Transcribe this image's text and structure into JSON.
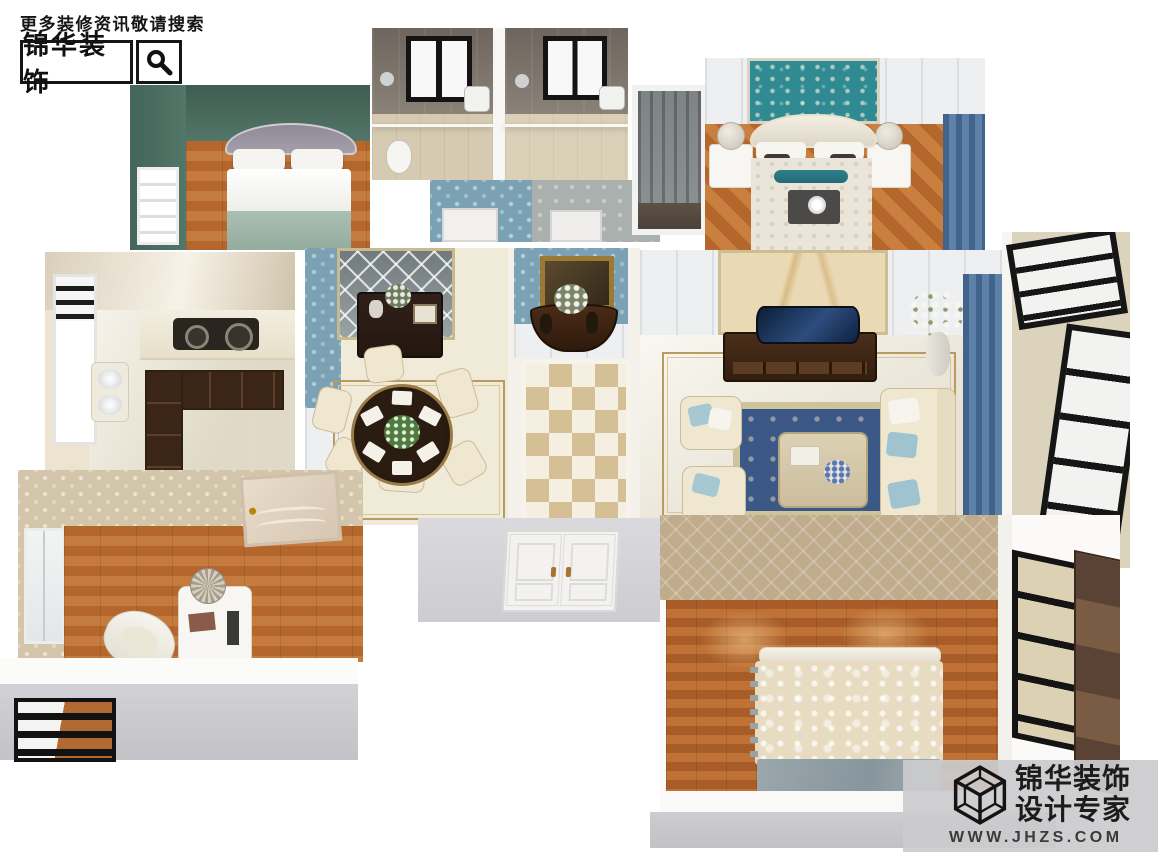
{
  "watermark_top": {
    "tagline": "更多装修资讯敬请搜索",
    "brand": "锦华装饰",
    "search_icon": "magnifier-icon"
  },
  "watermark_bottom": {
    "brand_line1": "锦华装饰",
    "brand_line2": "设计专家",
    "website": "WWW.JHZS.COM",
    "logo": "cube-wireframe-logo"
  },
  "scene": {
    "type": "3d-rendered-floorplan",
    "style": "european-classic-apartment-interior",
    "rooms": [
      {
        "name": "secondary-bedroom",
        "position": "top-left",
        "walls": "dark green",
        "floor": "wood",
        "furniture": [
          "gray tufted bed",
          "white pillows",
          "sage blanket",
          "window"
        ]
      },
      {
        "name": "bathroom-1",
        "position": "top-center",
        "walls": "gray-brown tile",
        "floor": "beige tile",
        "furniture": [
          "window",
          "glass shower",
          "toilet"
        ]
      },
      {
        "name": "bathroom-2",
        "position": "top-center",
        "walls": "gray-brown tile",
        "floor": "beige tile",
        "furniture": [
          "window",
          "glass shower",
          "toilet"
        ]
      },
      {
        "name": "walk-in-closet",
        "position": "top-center-right",
        "walls": "white",
        "furniture": [
          "gray hanging wardrobe"
        ]
      },
      {
        "name": "master-bedroom",
        "position": "top-right",
        "walls": "white panels + teal floral accent",
        "floor": "orange parquet",
        "furniture": [
          "white bed",
          "teal bolster",
          "two nightstands with lamps",
          "blue curtains"
        ]
      },
      {
        "name": "kitchen",
        "position": "middle-left",
        "floor": "cream marble",
        "furniture": [
          "dark wood cabinets",
          "gas stove",
          "sink",
          "window"
        ]
      },
      {
        "name": "dining-room",
        "position": "middle-center-left",
        "walls": "blue damask",
        "floor": "marble with inlay",
        "furniture": [
          "mirror panel",
          "dark buffet",
          "round black table",
          "cream chairs",
          "plant centerpiece"
        ]
      },
      {
        "name": "foyer",
        "position": "middle-center",
        "walls": "blue damask",
        "floor": "beige-white pinwheel tile",
        "furniture": [
          "gold framed painting",
          "dark console with flowers"
        ]
      },
      {
        "name": "living-room",
        "position": "middle-right",
        "walls": "white panels + marble TV wall",
        "floor": "marble with inlay",
        "furniture": [
          "curved TV",
          "dark TV cabinet",
          "blue ornate rug",
          "cream sofas",
          "blue pillows",
          "coffee table",
          "white flowers",
          "blue curtains"
        ]
      },
      {
        "name": "balcony-right",
        "position": "right",
        "floor": "beige",
        "furniture": [
          "black framed windows"
        ]
      },
      {
        "name": "study",
        "position": "bottom-left",
        "walls": "beige damask",
        "floor": "wood",
        "furniture": [
          "white desk",
          "desk lamp",
          "white chair",
          "door",
          "window"
        ]
      },
      {
        "name": "balcony-bottom-left",
        "position": "bottom-left",
        "furniture": [
          "black grid window"
        ]
      },
      {
        "name": "entry",
        "position": "bottom-center",
        "furniture": [
          "white double door with gold handles"
        ]
      },
      {
        "name": "third-bedroom",
        "position": "bottom-right",
        "walls": "beige diamond wallpaper",
        "floor": "orange wood",
        "furniture": [
          "bed with cream paisley duvet",
          "gray-blue throw",
          "black framed window",
          "dark wardrobe"
        ]
      }
    ]
  },
  "colors": {
    "greenwall": "#527668",
    "teal": "#2f8a92",
    "wood": "#b4662c",
    "marble": "#ece5d2",
    "bluepaper": "#7ba2b4",
    "rugblue": "#3c5886",
    "curtain": "#5d81a8",
    "darkwood": "#3a2516",
    "wmtext": "#1c1c1c"
  }
}
